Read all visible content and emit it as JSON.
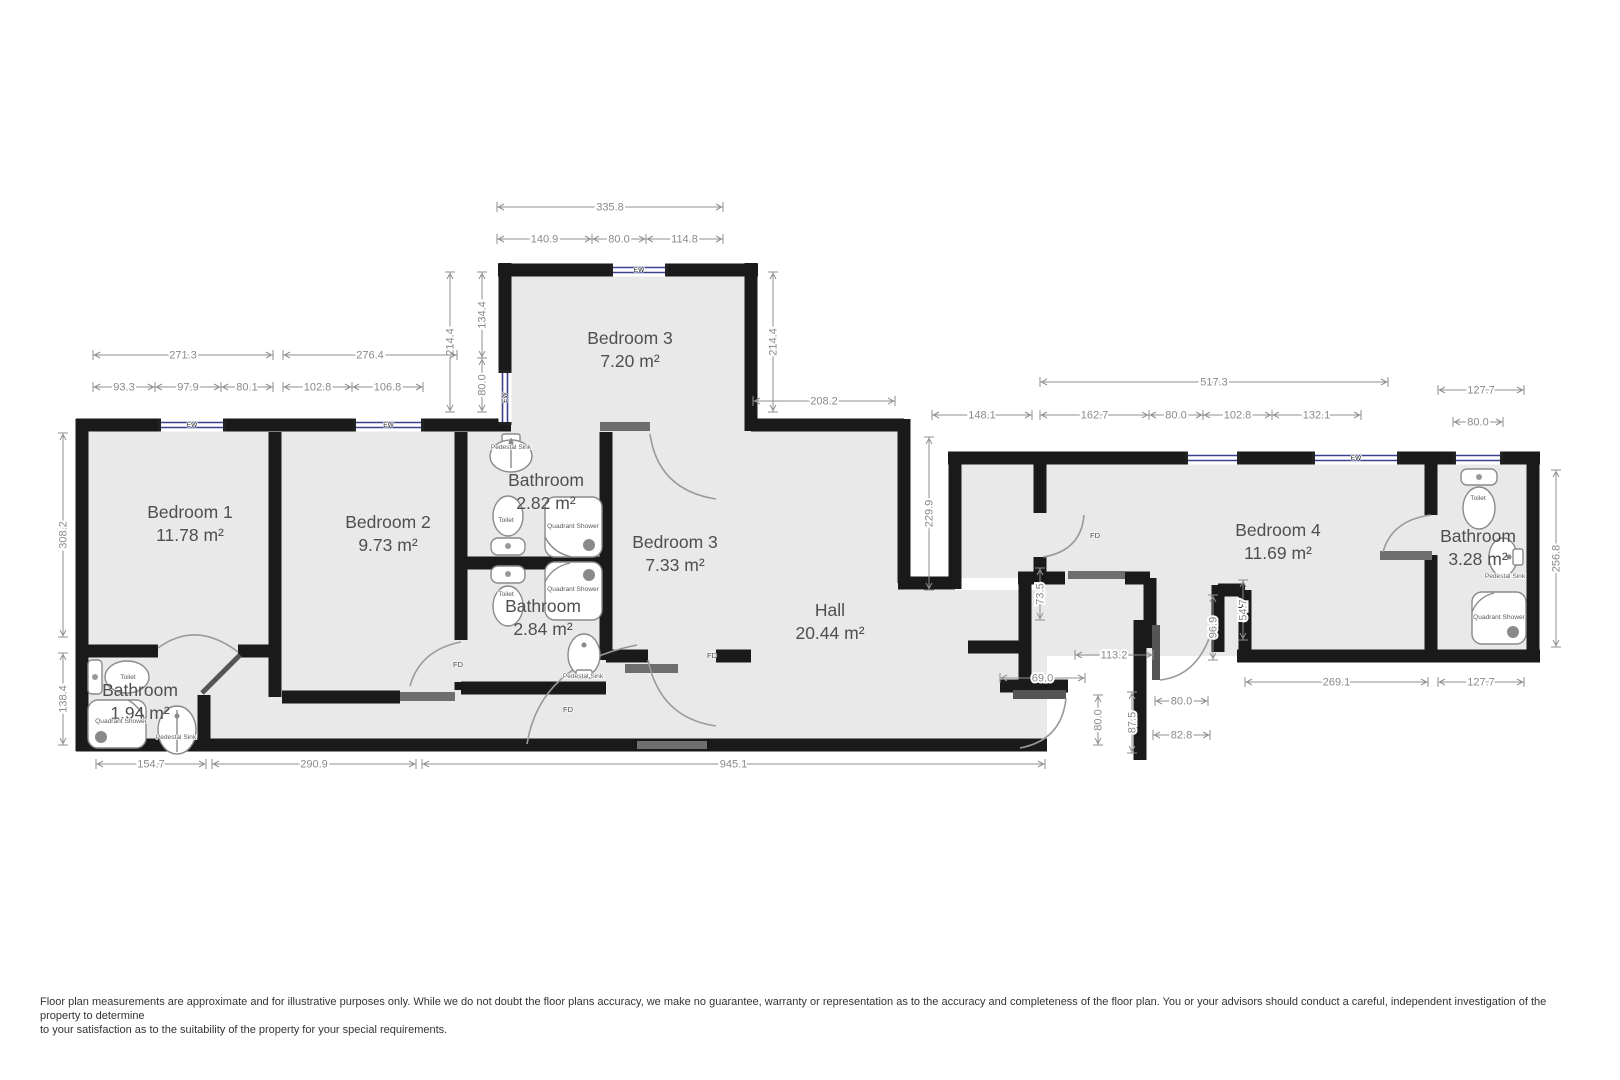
{
  "colors": {
    "wall": "#1a1a1a",
    "floor": "#e9e9e9",
    "dimension": "#8f8f8f",
    "room_text": "#4f4f4f",
    "window_blue": "#39418f",
    "door_leaf": "#555555",
    "lintel": "#6e6e6e"
  },
  "rooms": [
    {
      "name": "Bedroom 1",
      "area": "11.78 m²",
      "x": 190,
      "y": 518
    },
    {
      "name": "Bedroom 2",
      "area": "9.73 m²",
      "x": 388,
      "y": 528
    },
    {
      "name": "Bedroom 3",
      "area": "7.20 m²",
      "x": 630,
      "y": 344
    },
    {
      "name": "Bathroom",
      "area": "2.82 m²",
      "x": 546,
      "y": 486
    },
    {
      "name": "Bathroom",
      "area": "2.84 m²",
      "x": 543,
      "y": 612
    },
    {
      "name": "Bedroom 3",
      "area": "7.33 m²",
      "x": 675,
      "y": 548
    },
    {
      "name": "Hall",
      "area": "20.44 m²",
      "x": 830,
      "y": 616
    },
    {
      "name": "Bedroom 4",
      "area": "11.69 m²",
      "x": 1278,
      "y": 536
    },
    {
      "name": "Bathroom",
      "area": "3.28 m²",
      "x": 1478,
      "y": 542
    },
    {
      "name": "Bathroom",
      "area": "1.94 m²",
      "x": 140,
      "y": 696
    }
  ],
  "dimensions": [
    {
      "label": "335.8",
      "o": "h",
      "y": 207,
      "s": 497,
      "e": 723
    },
    {
      "label": "140.9",
      "o": "h",
      "y": 239,
      "s": 497,
      "e": 592
    },
    {
      "label": "80.0",
      "o": "h",
      "y": 239,
      "s": 592,
      "e": 646
    },
    {
      "label": "114.8",
      "o": "h",
      "y": 239,
      "s": 646,
      "e": 723
    },
    {
      "label": "214.4",
      "o": "v",
      "x": 450,
      "s": 272,
      "e": 412
    },
    {
      "label": "134.4",
      "o": "v",
      "x": 482,
      "s": 272,
      "e": 358
    },
    {
      "label": "80.0",
      "o": "v",
      "x": 482,
      "s": 358,
      "e": 412
    },
    {
      "label": "214.4",
      "o": "v",
      "x": 773,
      "s": 272,
      "e": 412
    },
    {
      "label": "271.3",
      "o": "h",
      "y": 355,
      "s": 93,
      "e": 273
    },
    {
      "label": "93.3",
      "o": "h",
      "y": 387,
      "s": 93,
      "e": 155
    },
    {
      "label": "97.9",
      "o": "h",
      "y": 387,
      "s": 155,
      "e": 221
    },
    {
      "label": "80.1",
      "o": "h",
      "y": 387,
      "s": 221,
      "e": 273
    },
    {
      "label": "276.4",
      "o": "h",
      "y": 355,
      "s": 283,
      "e": 457
    },
    {
      "label": "102.8",
      "o": "h",
      "y": 387,
      "s": 283,
      "e": 352
    },
    {
      "label": "106.8",
      "o": "h",
      "y": 387,
      "s": 352,
      "e": 423
    },
    {
      "label": "308.2",
      "o": "v",
      "x": 63,
      "s": 433,
      "e": 637
    },
    {
      "label": "138.4",
      "o": "v",
      "x": 63,
      "s": 653,
      "e": 745
    },
    {
      "label": "154.7",
      "o": "h",
      "y": 764,
      "s": 96,
      "e": 206
    },
    {
      "label": "290.9",
      "o": "h",
      "y": 764,
      "s": 212,
      "e": 416
    },
    {
      "label": "945.1",
      "o": "h",
      "y": 764,
      "s": 422,
      "e": 1045
    },
    {
      "label": "208.2",
      "o": "h",
      "y": 401,
      "s": 753,
      "e": 895
    },
    {
      "label": "229.9",
      "o": "v",
      "x": 929,
      "s": 437,
      "e": 590
    },
    {
      "label": "148.1",
      "o": "h",
      "y": 415,
      "s": 932,
      "e": 1032
    },
    {
      "label": "517.3",
      "o": "h",
      "y": 382,
      "s": 1040,
      "e": 1388
    },
    {
      "label": "162.7",
      "o": "h",
      "y": 415,
      "s": 1040,
      "e": 1149
    },
    {
      "label": "80.0",
      "o": "h",
      "y": 415,
      "s": 1149,
      "e": 1203
    },
    {
      "label": "102.8",
      "o": "h",
      "y": 415,
      "s": 1203,
      "e": 1272
    },
    {
      "label": "132.1",
      "o": "h",
      "y": 415,
      "s": 1272,
      "e": 1361
    },
    {
      "label": "127.7",
      "o": "h",
      "y": 390,
      "s": 1438,
      "e": 1524
    },
    {
      "label": "80.0",
      "o": "h",
      "y": 422,
      "s": 1453,
      "e": 1503
    },
    {
      "label": "256.8",
      "o": "v",
      "x": 1556,
      "s": 470,
      "e": 647
    },
    {
      "label": "269.1",
      "o": "h",
      "y": 682,
      "s": 1245,
      "e": 1428
    },
    {
      "label": "127.7",
      "o": "h",
      "y": 682,
      "s": 1438,
      "e": 1524
    },
    {
      "label": "113.2",
      "o": "h",
      "y": 655,
      "s": 1075,
      "e": 1153
    },
    {
      "label": "69.0",
      "o": "h",
      "y": 678,
      "s": 1000,
      "e": 1085
    },
    {
      "label": "73.5",
      "o": "v",
      "x": 1040,
      "s": 568,
      "e": 620
    },
    {
      "label": "96.9",
      "o": "v",
      "x": 1213,
      "s": 595,
      "e": 660
    },
    {
      "label": "54.7",
      "o": "v",
      "x": 1243,
      "s": 580,
      "e": 640
    },
    {
      "label": "80.0",
      "o": "v",
      "x": 1098,
      "s": 695,
      "e": 745
    },
    {
      "label": "87.5",
      "o": "v",
      "x": 1132,
      "s": 692,
      "e": 753
    },
    {
      "label": "80.0",
      "o": "h",
      "y": 701,
      "s": 1155,
      "e": 1208
    },
    {
      "label": "82.8",
      "o": "h",
      "y": 735,
      "s": 1153,
      "e": 1210
    }
  ],
  "windows": [
    {
      "label": "EW",
      "o": "h",
      "x": 158,
      "y": 425,
      "len": 68
    },
    {
      "label": "EW",
      "o": "h",
      "x": 353,
      "y": 425,
      "len": 71
    },
    {
      "label": "EW",
      "o": "h",
      "x": 610,
      "y": 270,
      "len": 58
    },
    {
      "label": "EW",
      "o": "v",
      "x": 505,
      "y": 370,
      "len": 55
    },
    {
      "label": "",
      "o": "h",
      "x": 1185,
      "y": 458,
      "len": 55
    },
    {
      "label": "EW",
      "o": "h",
      "x": 1312,
      "y": 458,
      "len": 88
    },
    {
      "label": "",
      "o": "h",
      "x": 1453,
      "y": 458,
      "len": 50
    }
  ],
  "door_labels": [
    {
      "label": "FD",
      "x": 458,
      "y": 667
    },
    {
      "label": "FD",
      "x": 712,
      "y": 658
    },
    {
      "label": "FD",
      "x": 568,
      "y": 712
    },
    {
      "label": "FD",
      "x": 1095,
      "y": 538
    }
  ],
  "fixture_labels": [
    {
      "label": "Pedestal Sink",
      "x": 511,
      "y": 449
    },
    {
      "label": "Toilet",
      "x": 506,
      "y": 522
    },
    {
      "label": "Quadrant Shower",
      "x": 573,
      "y": 528
    },
    {
      "label": "Toilet",
      "x": 506,
      "y": 596
    },
    {
      "label": "Quadrant Shower",
      "x": 573,
      "y": 591
    },
    {
      "label": "Pedestal Sink",
      "x": 583,
      "y": 678
    },
    {
      "label": "Toilet",
      "x": 128,
      "y": 679
    },
    {
      "label": "Quadrant Shower",
      "x": 121,
      "y": 723
    },
    {
      "label": "Pedestal Sink",
      "x": 176,
      "y": 739
    },
    {
      "label": "Toilet",
      "x": 1478,
      "y": 500
    },
    {
      "label": "Pedestal Sink",
      "x": 1505,
      "y": 578
    },
    {
      "label": "Quadrant Shower",
      "x": 1499,
      "y": 619
    }
  ],
  "disclaimer": {
    "line1": "Floor plan measurements are approximate and for illustrative purposes only. While we do not doubt the floor plans accuracy, we make no guarantee, warranty or representation as to the accuracy and completeness of the floor plan. You or your advisors should conduct a careful, independent investigation of the",
    "line2": "property to determine",
    "line3": " to your satisfaction as to the suitability of the property for your special requirements."
  }
}
